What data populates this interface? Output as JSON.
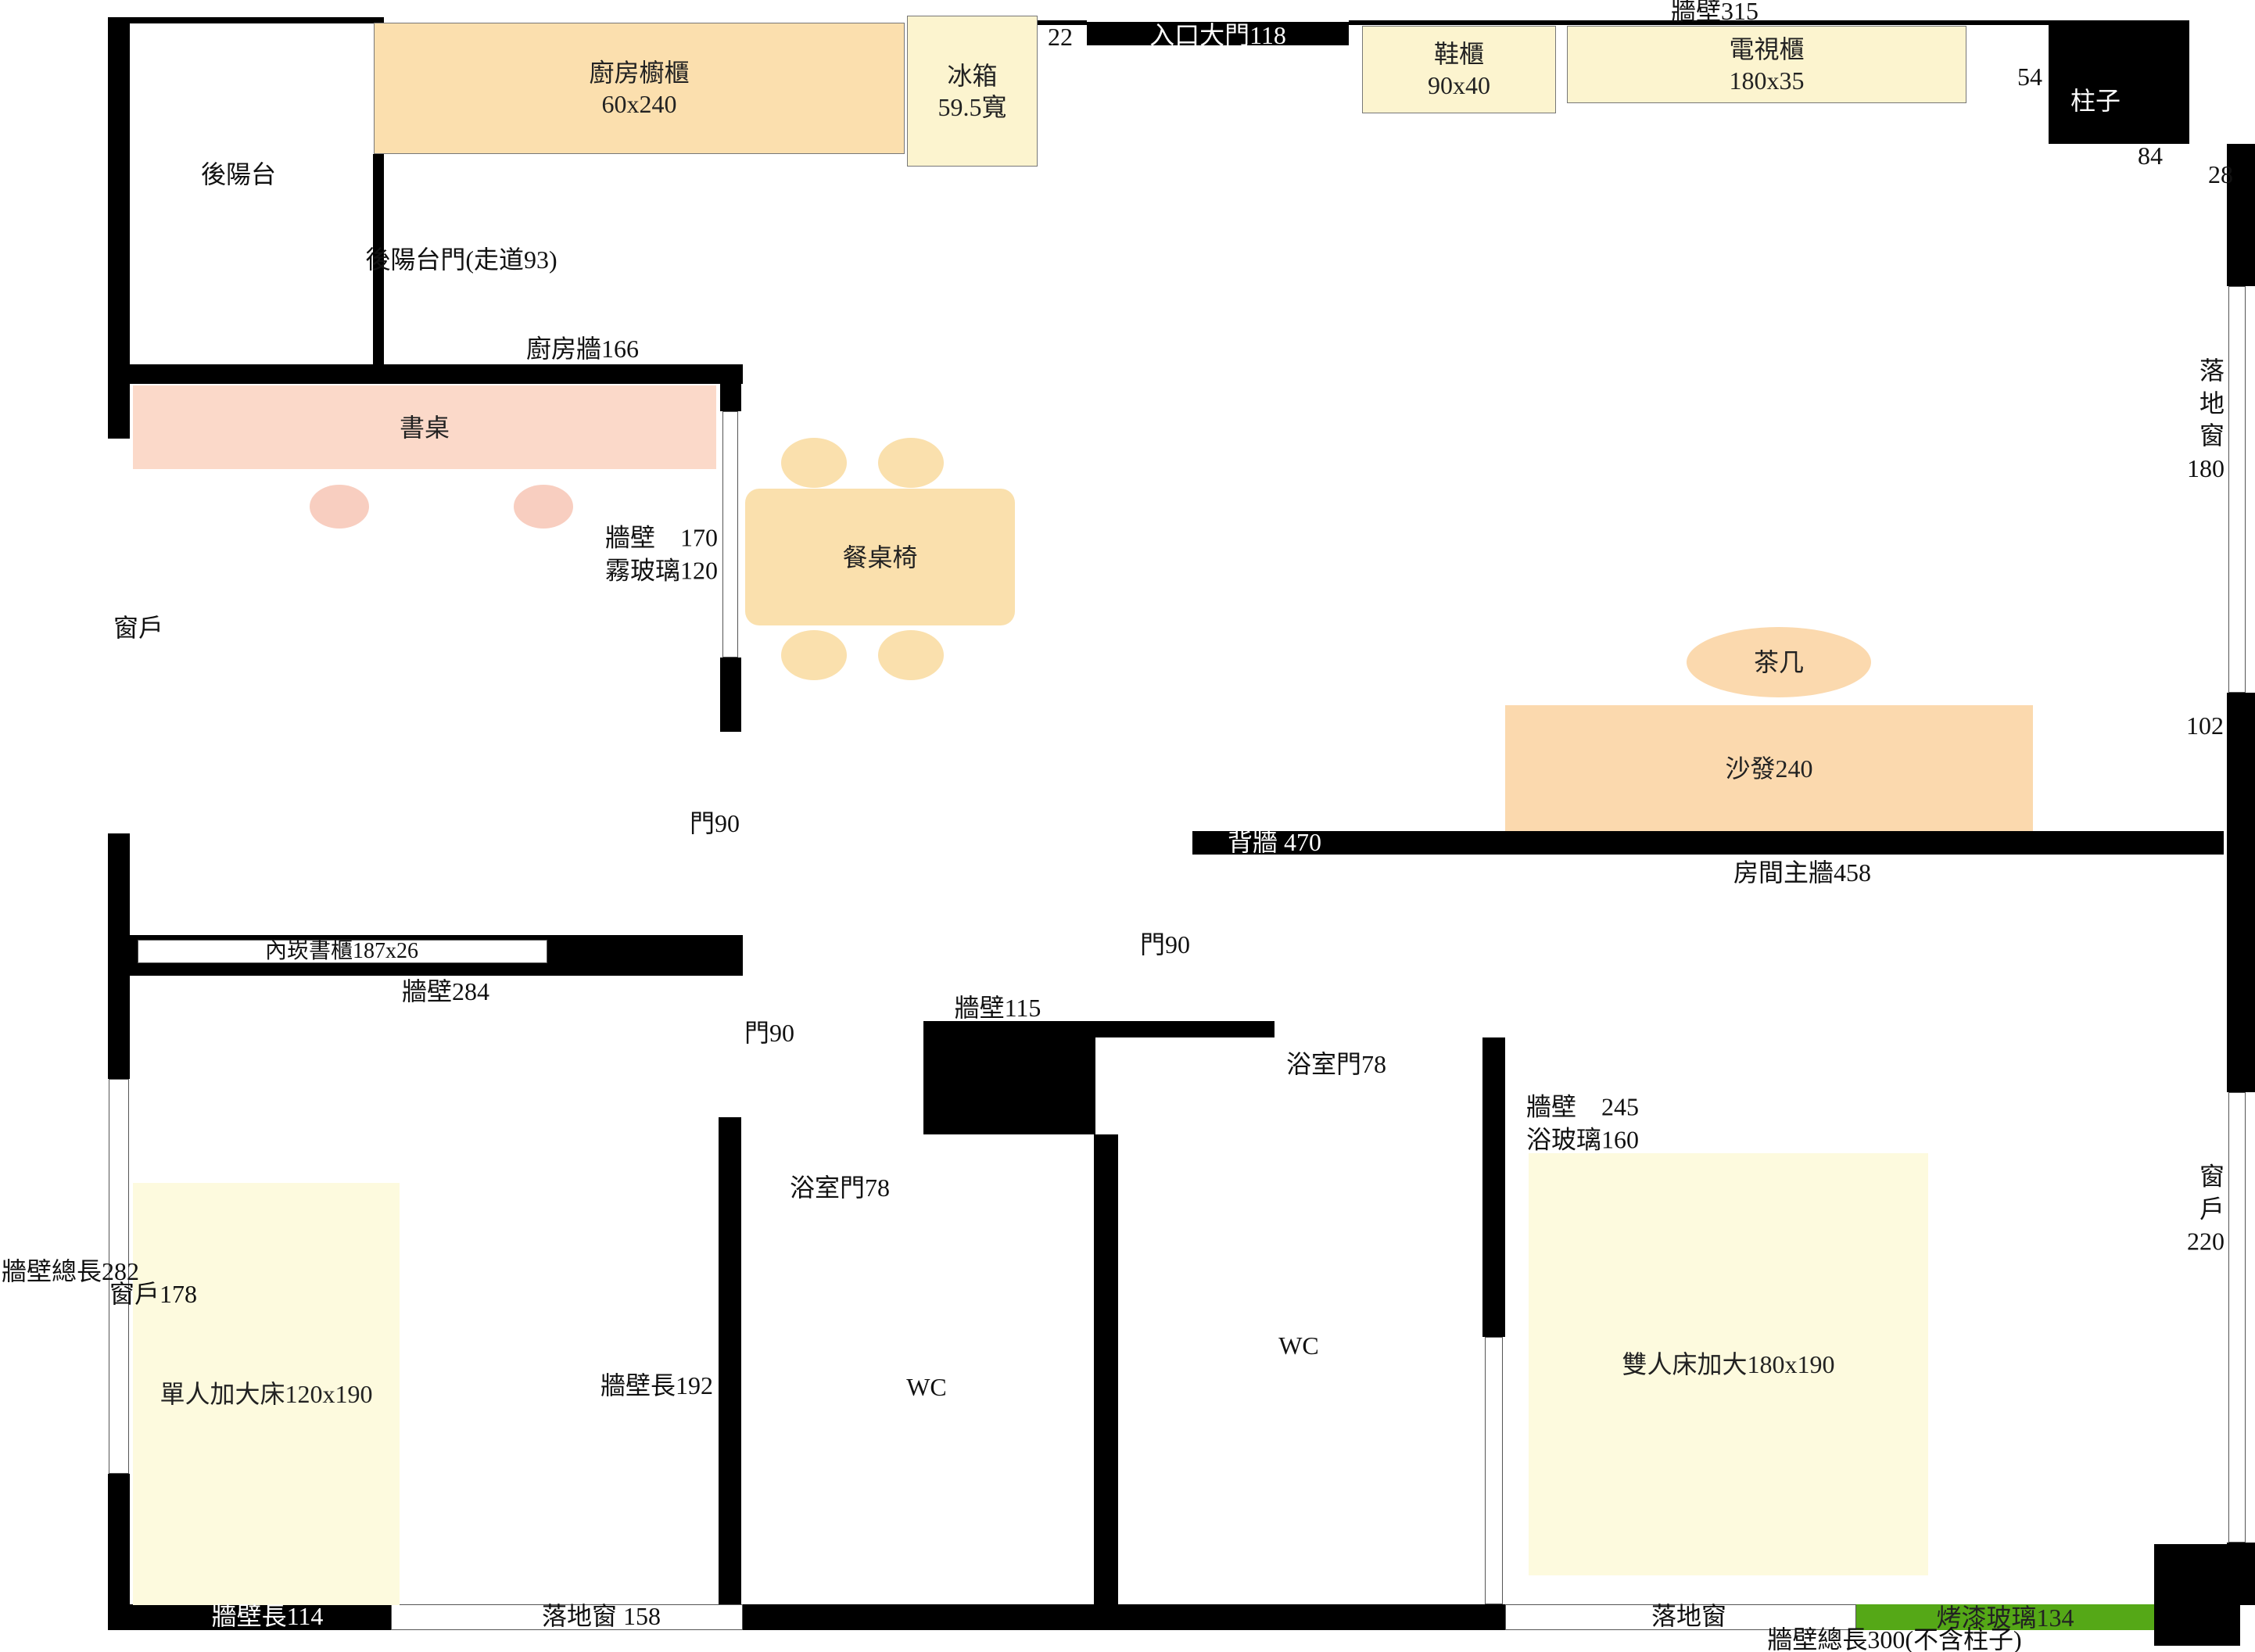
{
  "title": "apartment floor plan",
  "colors": {
    "wall": "#000000",
    "kitchen": "#fbdfae",
    "yellow": "#fcf4cf",
    "pink": "#fbd9c9",
    "chair": "#f8cec0",
    "dining": "#fae0ad",
    "peach": "#fbd9ae",
    "cream": "#fdfade",
    "green": "#55a817"
  },
  "labels": {
    "wall315": "牆壁315",
    "n22": "22",
    "entrance": "入口大門118",
    "shoe_cabinet": "鞋櫃\n90x40",
    "tv_cabinet": "電視櫃\n180x35",
    "n54": "54",
    "pillar": "柱子",
    "n84": "84",
    "n28": "28",
    "balcony": "後陽台",
    "kitchen_cabinet": "廚房櫥櫃\n60x240",
    "fridge": "冰箱\n59.5寬",
    "balcony_door": "後陽台門(走道93)",
    "kitchen_wall": "廚房牆166",
    "floor_window_180": "落地窗\n180",
    "desk": "書桌",
    "wall170_glass": "牆壁　170\n霧玻璃120",
    "dining_table": "餐桌椅",
    "window_left": "窗戶",
    "coffee_table": "茶几",
    "sofa": "沙發240",
    "n102": "102",
    "door90_a": "門90",
    "back_wall": "背牆 470",
    "main_wall": "房間主牆458",
    "bookcase": "內崁書櫃187x26",
    "wall284": "牆壁284",
    "door90_b": "門90",
    "wall115": "牆壁115",
    "door90_c": "門90",
    "bath_door_b": "浴室門78",
    "wall245_glass": "牆壁　245\n浴玻璃160",
    "bath_door_a": "浴室門78",
    "window_220": "窗戶\n220",
    "wall282_total": "牆壁總長282",
    "window178": "窗戶178",
    "wc1": "WC",
    "wc2": "WC",
    "double_bed": "雙人床加大180x190",
    "wall192": "牆壁長192",
    "single_bed": "單人加大床120x190",
    "wall114": "牆壁長114",
    "floor_window_158": "落地窗 158",
    "floor_window_b": "落地窗",
    "painted_glass": "烤漆玻璃134",
    "wall300_total": "牆壁總長300(不含柱子)"
  }
}
